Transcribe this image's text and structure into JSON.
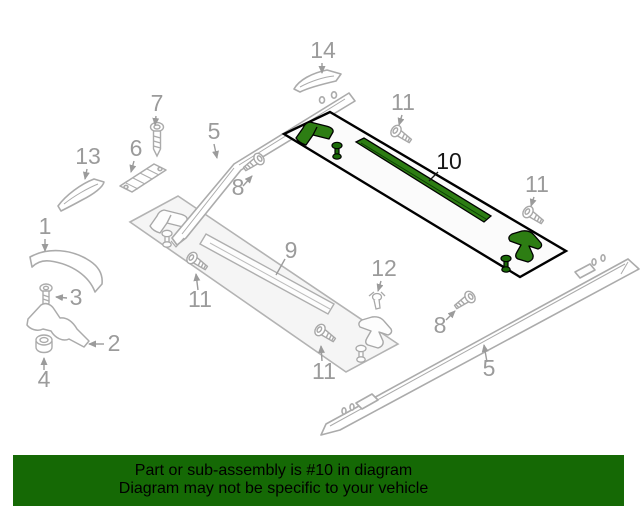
{
  "diagram": {
    "callout_labels": {
      "1": "1",
      "2": "2",
      "3": "3",
      "4": "4",
      "5": "5",
      "6": "6",
      "7": "7",
      "8": "8",
      "9": "9",
      "10": "10",
      "11": "11",
      "12": "12",
      "13": "13",
      "14": "14"
    },
    "highlighted_part": "10"
  },
  "banner": {
    "line1": "Part or sub-assembly is #10 in diagram",
    "line2": "Diagram may not be specific to your vehicle"
  },
  "colors": {
    "banner_background": "#156905",
    "banner_text": "#000000",
    "highlight_fill": "#2d7d13",
    "highlight_fill_dark": "#1b6b08",
    "highlight_outline": "#000000",
    "line_art": "#ababab",
    "callout_text": "#9b9b9b",
    "part_fill": "#f5f5f5"
  }
}
